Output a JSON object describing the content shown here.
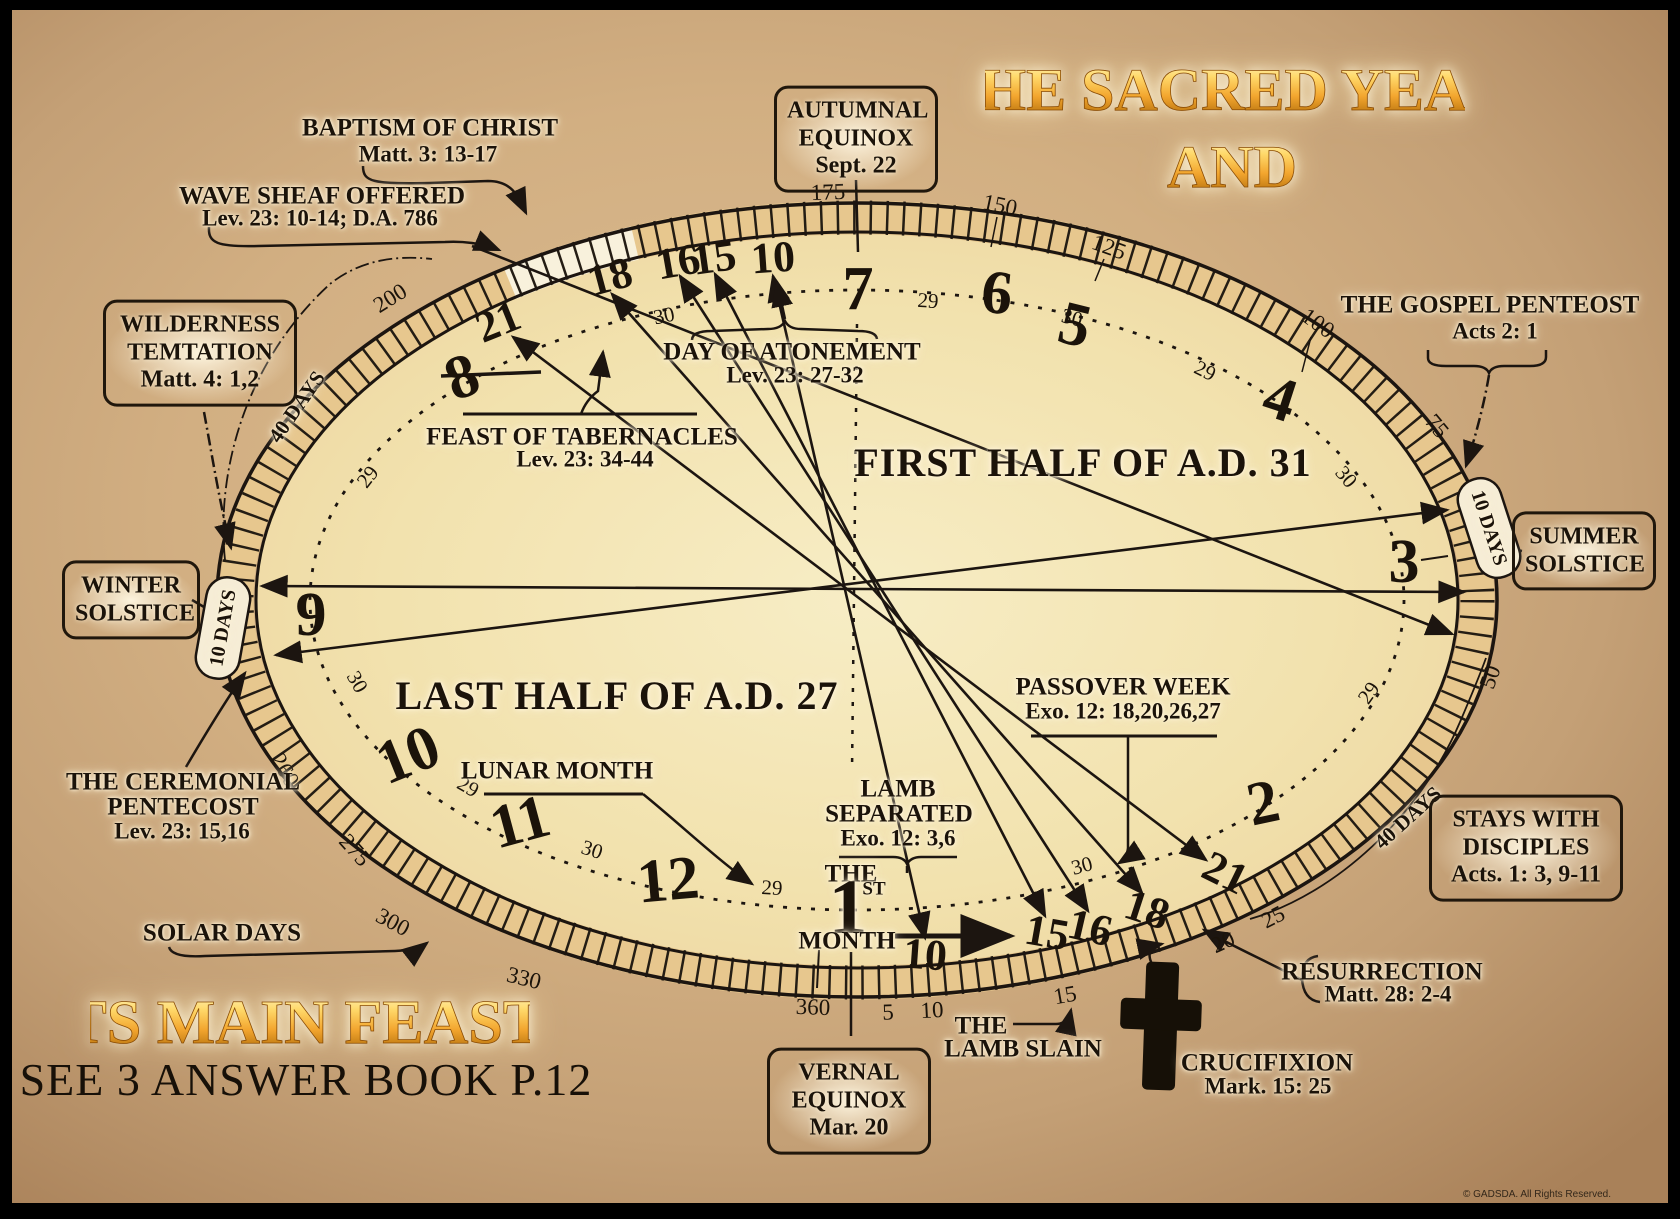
{
  "titles": {
    "line1": "THE SACRED YEAR",
    "line2": "AND",
    "feasts": "ITS MAIN FEASTS",
    "see": "SEE 3 ANSWER BOOK P.12",
    "copyright": "© GADSDA. All Rights Reserved."
  },
  "halves": {
    "first": "FIRST HALF OF A.D. 31",
    "last": "LAST HALF OF A.D. 27"
  },
  "months": [
    "7",
    "6",
    "5",
    "4",
    "3",
    "2",
    "1",
    "12",
    "11",
    "10",
    "9",
    "8"
  ],
  "month_one": {
    "the": "THE",
    "one": "1",
    "st": "ST",
    "month": "MONTH"
  },
  "tishri_days": [
    "21",
    "18",
    "16",
    "15",
    "10"
  ],
  "nisan_days": [
    "10",
    "15",
    "16",
    "18",
    "21"
  ],
  "lunar_lengths": [
    "29",
    "30",
    "29",
    "30",
    "29",
    "30",
    "29",
    "30",
    "29",
    "30",
    "29",
    "30"
  ],
  "solar_scale": [
    "175",
    "150",
    "125",
    "100",
    "75",
    "50",
    "25",
    "20",
    "15",
    "10",
    "5",
    "360",
    "330",
    "300",
    "275",
    "260",
    "200"
  ],
  "anns": {
    "baptism": {
      "t": "BAPTISM OF CHRIST",
      "r": "Matt. 3: 13-17"
    },
    "wave": {
      "t": "WAVE SHEAF OFFERED",
      "r": "Lev. 23: 10-14; D.A. 786"
    },
    "wilderness": {
      "l1": "WILDERNESS",
      "l2": "TEMTATION",
      "r": "Matt. 4: 1,2"
    },
    "autumnal": {
      "l1": "AUTUMNAL",
      "l2": "EQUINOX",
      "r": "Sept. 22"
    },
    "gospel": {
      "t": "THE GOSPEL PENTEOST",
      "r": "Acts 2: 1"
    },
    "atonement": {
      "t": "DAY OF ATONEMENT",
      "r": "Lev. 23: 27-32"
    },
    "tabernacles": {
      "t": "FEAST OF TABERNACLES",
      "r": "Lev. 23: 34-44"
    },
    "winter": {
      "l1": "WINTER",
      "l2": "SOLSTICE"
    },
    "summer": {
      "l1": "SUMMER",
      "l2": "SOLSTICE"
    },
    "ten_days": "10 DAYS",
    "forty_days": "40 DAYS",
    "ceremonial": {
      "l1": "THE CEREMONIAL",
      "l2": "PENTECOST",
      "r": "Lev. 23: 15,16"
    },
    "lunar_month": "LUNAR MONTH",
    "solar_days": "SOLAR DAYS",
    "passover": {
      "t": "PASSOVER WEEK",
      "r": "Exo. 12: 18,20,26,27"
    },
    "lamb_sep": {
      "l1": "LAMB",
      "l2": "SEPARATED",
      "r": "Exo. 12: 3,6"
    },
    "vernal": {
      "l1": "VERNAL",
      "l2": "EQUINOX",
      "r": "Mar. 20"
    },
    "lamb_slain": {
      "l1": "THE",
      "l2": "LAMB SLAIN"
    },
    "stays": {
      "l1": "STAYS WITH",
      "l2": "DISCIPLES",
      "r": "Acts. 1: 3, 9-11"
    },
    "resurrection": {
      "t": "RESURRECTION",
      "r": "Matt. 28: 2-4"
    },
    "crucifixion": {
      "t": "CRUCIFIXION",
      "r": "Mark. 15: 25"
    }
  }
}
